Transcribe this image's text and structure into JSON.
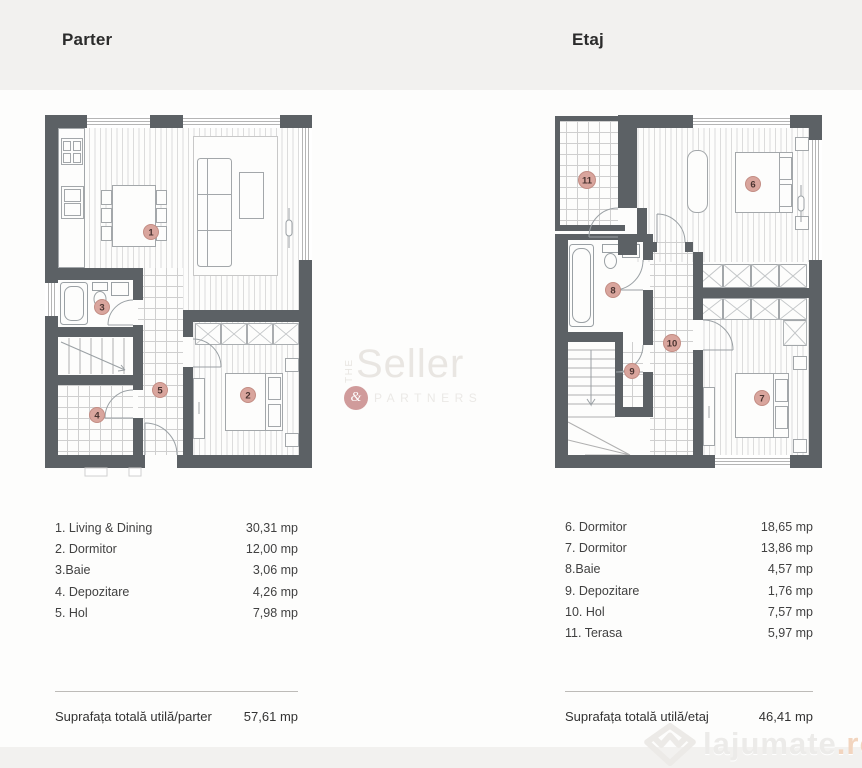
{
  "titles": {
    "left": "Parter",
    "right": "Etaj"
  },
  "parter": {
    "legend": [
      {
        "label": "1. Living & Dining",
        "value": "30,31 mp"
      },
      {
        "label": "2. Dormitor",
        "value": "12,00 mp"
      },
      {
        "label": "3.Baie",
        "value": "3,06 mp"
      },
      {
        "label": "4. Depozitare",
        "value": "4,26 mp"
      },
      {
        "label": "5. Hol",
        "value": "7,98 mp"
      }
    ],
    "total_label": "Suprafața totală utilă/parter",
    "total_value": "57,61 mp",
    "markers": [
      "1",
      "2",
      "3",
      "4",
      "5"
    ]
  },
  "etaj": {
    "legend": [
      {
        "label": "6. Dormitor",
        "value": "18,65 mp"
      },
      {
        "label": "7. Dormitor",
        "value": "13,86 mp"
      },
      {
        "label": "8.Baie",
        "value": "4,57 mp"
      },
      {
        "label": "9. Depozitare",
        "value": "1,76 mp"
      },
      {
        "label": "10. Hol",
        "value": "7,57 mp"
      },
      {
        "label": "11. Terasa",
        "value": "5,97 mp"
      }
    ],
    "total_label": "Suprafața totală utilă/etaj",
    "total_value": "46,41 mp",
    "markers": [
      "6",
      "7",
      "8",
      "9",
      "10",
      "11"
    ]
  },
  "watermark": {
    "the": "THE",
    "name": "Seller",
    "amp": "&",
    "partners": "PARTNERS"
  },
  "brand": {
    "name": "lajumate",
    "tld": ".ro"
  },
  "colors": {
    "wall": "#5c6165",
    "marker_fill": "#d9a59d",
    "brand_tld": "#f2d5bf"
  }
}
